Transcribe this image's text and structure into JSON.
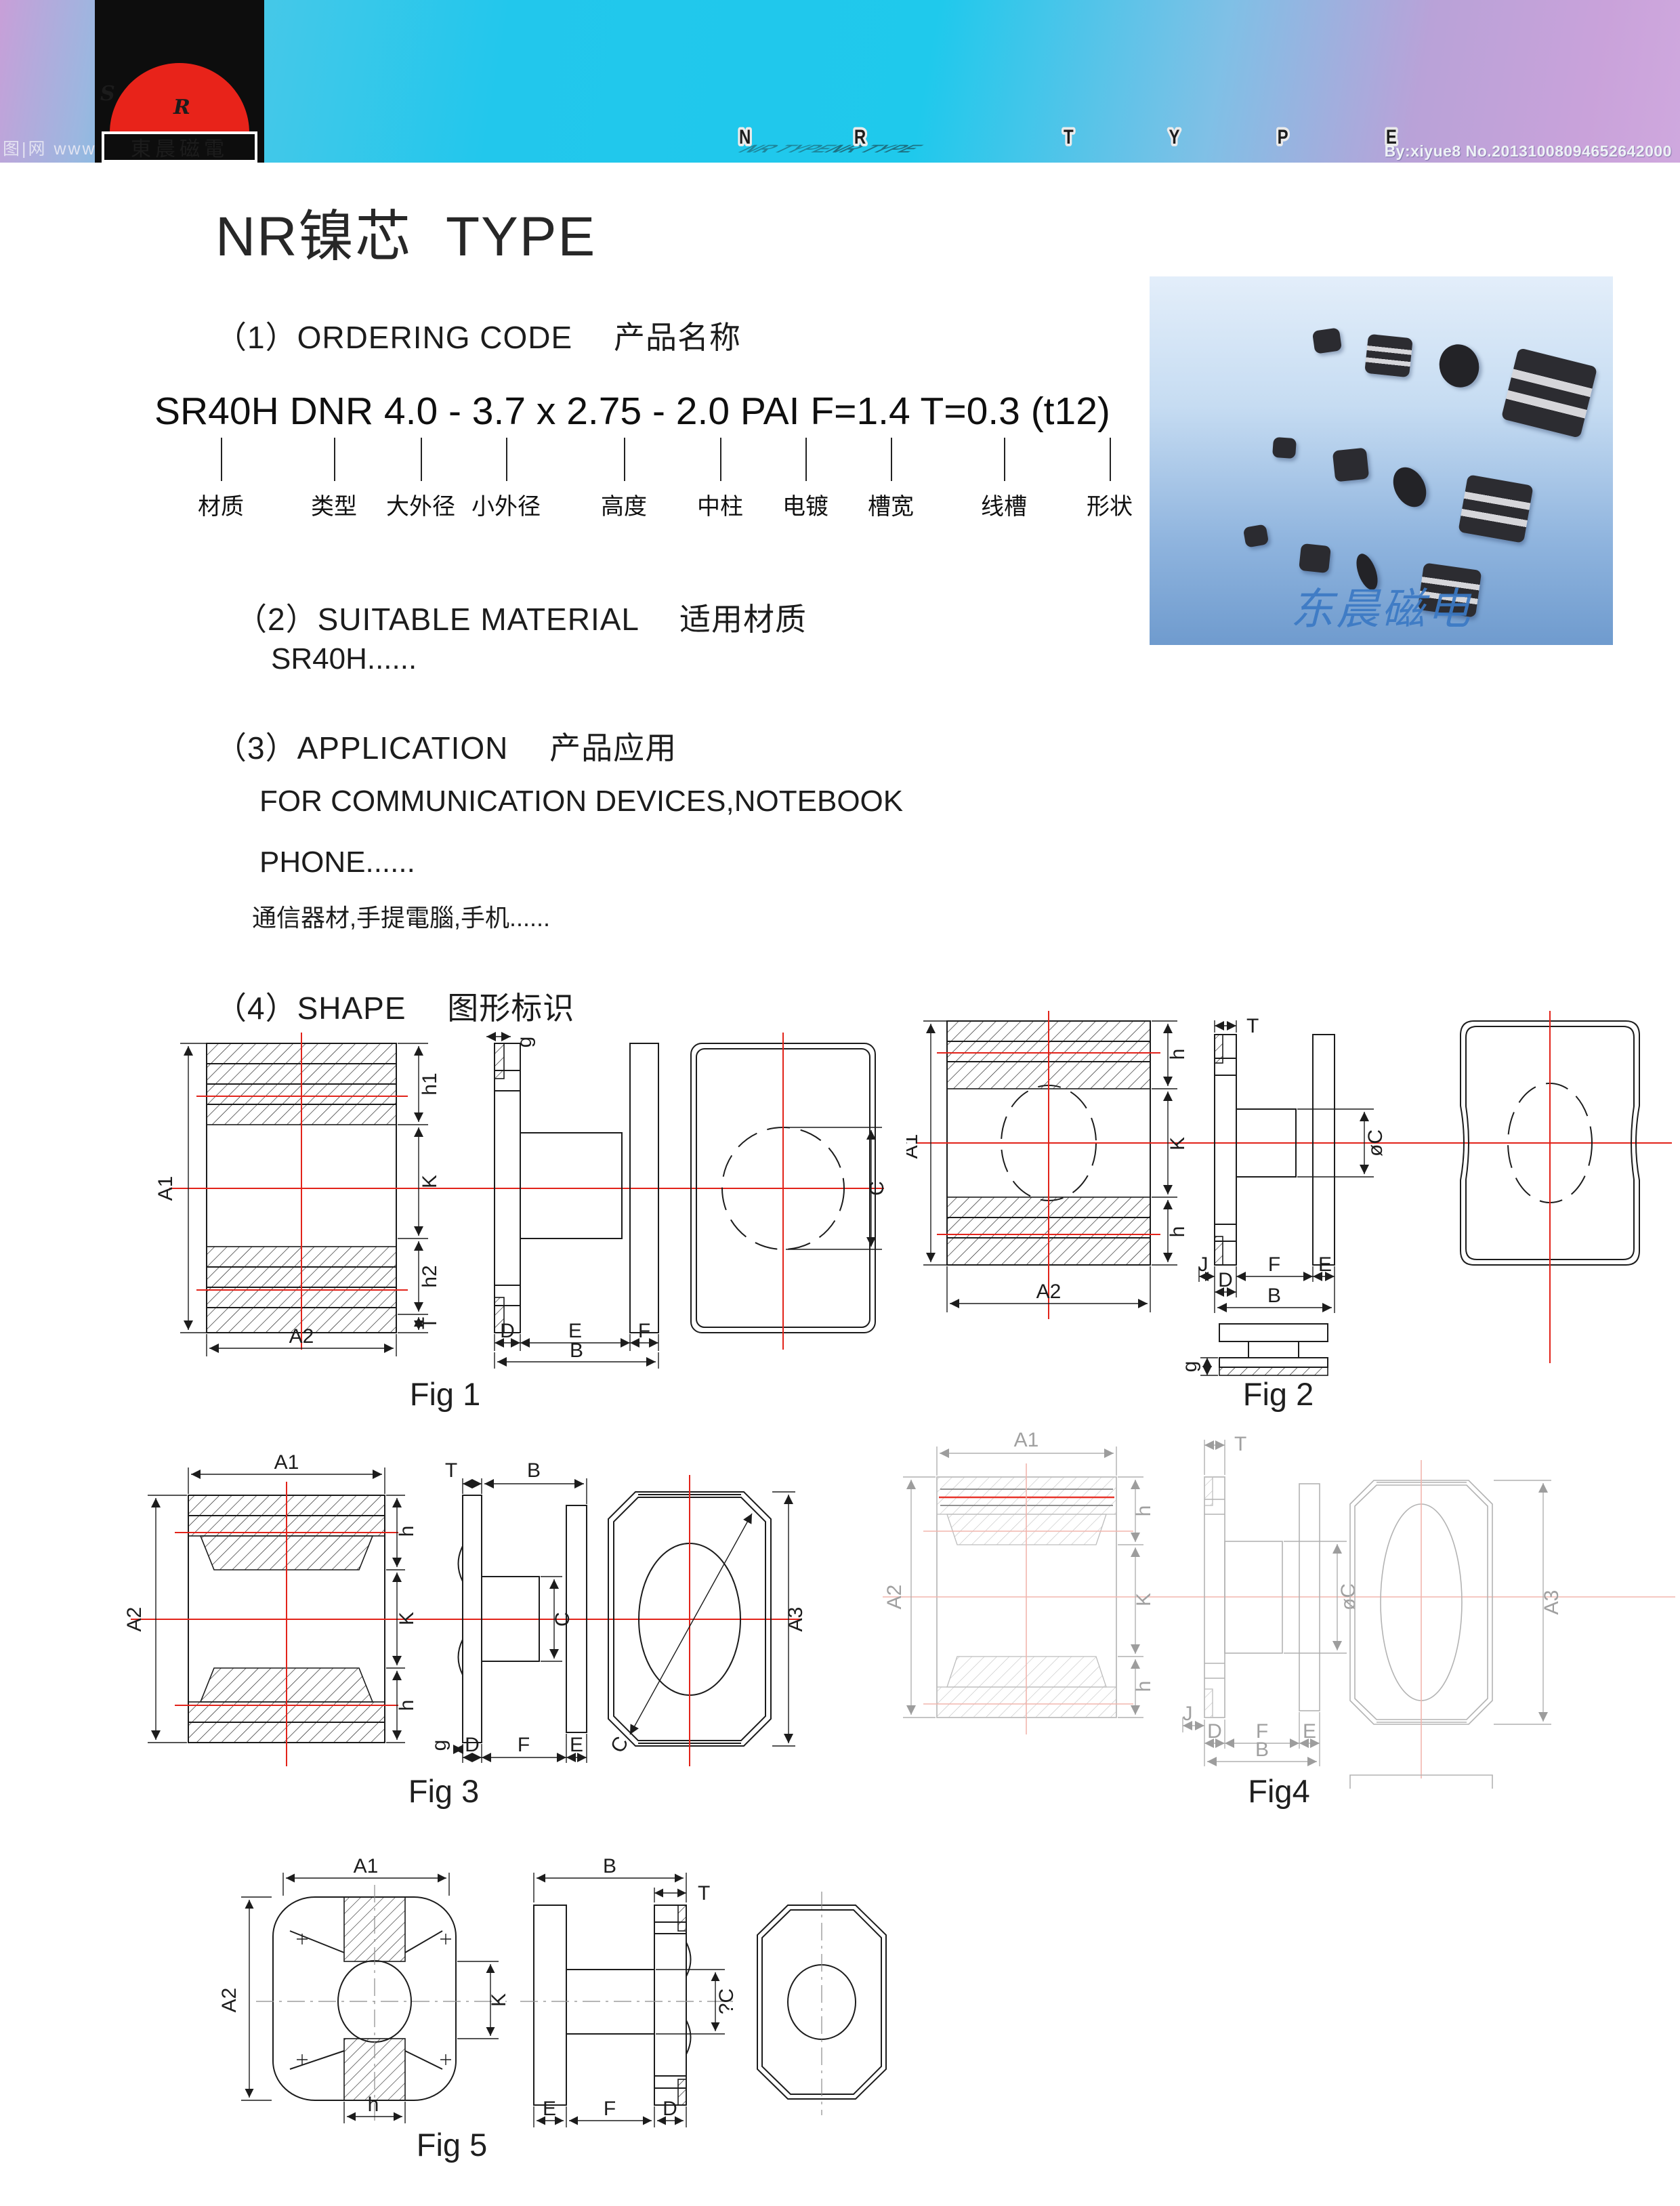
{
  "banner": {
    "logo": {
      "s": "S",
      "r": "R",
      "company": "東晨磁電"
    },
    "shadow_text": "NR TYPE",
    "letters": [
      {
        "ch": "N",
        "c1": "#8f00b8",
        "c2": "#ff0098"
      },
      {
        "ch": "R",
        "c1": "#f01448",
        "c2": "#ff7a00"
      },
      {
        "ch": "T",
        "c1": "#f6f600",
        "c2": "#9fce10"
      },
      {
        "ch": "Y",
        "c1": "#0c6e34",
        "c2": "#16a84e"
      },
      {
        "ch": "P",
        "c1": "#2a46e0",
        "c2": "#0d12f2"
      },
      {
        "ch": "E",
        "c1": "#5a14d8",
        "c2": "#ce00c8"
      }
    ],
    "watermark_left": "图|网 www",
    "credit": "By:xiyue8  No.20131008094652642000"
  },
  "page": {
    "title": "NR镍芯  TYPE"
  },
  "sections": {
    "s1_heading": "（1）ORDERING CODE　 产品名称",
    "s2_heading": "（2）SUITABLE MATERIAL　 适用材质",
    "s2_body": "SR40H......",
    "s3_heading": "（3）APPLICATION　 产品应用",
    "s3_line1": "FOR COMMUNICATION DEVICES,NOTEBOOK",
    "s3_line2": "PHONE......",
    "s3_line3": "通信器材,手提電腦,手机......",
    "s4_heading": "（4）SHAPE　 图形标识"
  },
  "ordering": {
    "code": "SR40H DNR 4.0 - 3.7 x 2.75 - 2.0 PAI F=1.4 T=0.3 (t12)",
    "labels": [
      "材质",
      "类型",
      "大外径",
      "小外径",
      "高度",
      "中柱",
      "电镀",
      "槽宽",
      "线槽",
      "形状"
    ]
  },
  "product_image": {
    "watermark": "东晨磁电"
  },
  "figures": {
    "fig1": {
      "caption": "Fig 1",
      "dims": {
        "a1": "A1",
        "a2": "A2",
        "h1": "h1",
        "k": "K",
        "h2": "h2",
        "t": "T",
        "g": "g",
        "d": "D",
        "e": "E",
        "f": "F",
        "b": "B",
        "c": "C"
      }
    },
    "fig2": {
      "caption": "Fig 2",
      "dims": {
        "a1": "A1",
        "a2": "A2",
        "h_top": "h",
        "k": "K",
        "h_bot": "h",
        "t": "T",
        "oc": "øC",
        "j": "J",
        "f": "F",
        "e": "E",
        "d": "D",
        "b": "B",
        "g": "g"
      }
    },
    "fig3": {
      "caption": "Fig 3",
      "dims": {
        "a1": "A1",
        "a2": "A2",
        "a3": "A3",
        "h_top": "h",
        "k": "K",
        "h_bot": "h",
        "t": "T",
        "b": "B",
        "c": "C",
        "g": "g",
        "d": "D",
        "f": "F",
        "e": "E",
        "c_diag": "C"
      }
    },
    "fig4": {
      "caption": "Fig4",
      "dims": {
        "a1": "A1",
        "a2": "A2",
        "a3": "A3",
        "h_top": "h",
        "k": "K",
        "h_bot": "h",
        "t": "T",
        "oc": "øC",
        "j": "J",
        "d": "D",
        "f": "F",
        "e": "E",
        "b": "B"
      }
    },
    "fig5": {
      "caption": "Fig 5",
      "dims": {
        "a1": "A1",
        "a2": "A2",
        "k": "K",
        "h": "h",
        "b": "B",
        "t": "T",
        "qc": "?C",
        "e": "E",
        "f": "F",
        "d": "D"
      }
    }
  }
}
